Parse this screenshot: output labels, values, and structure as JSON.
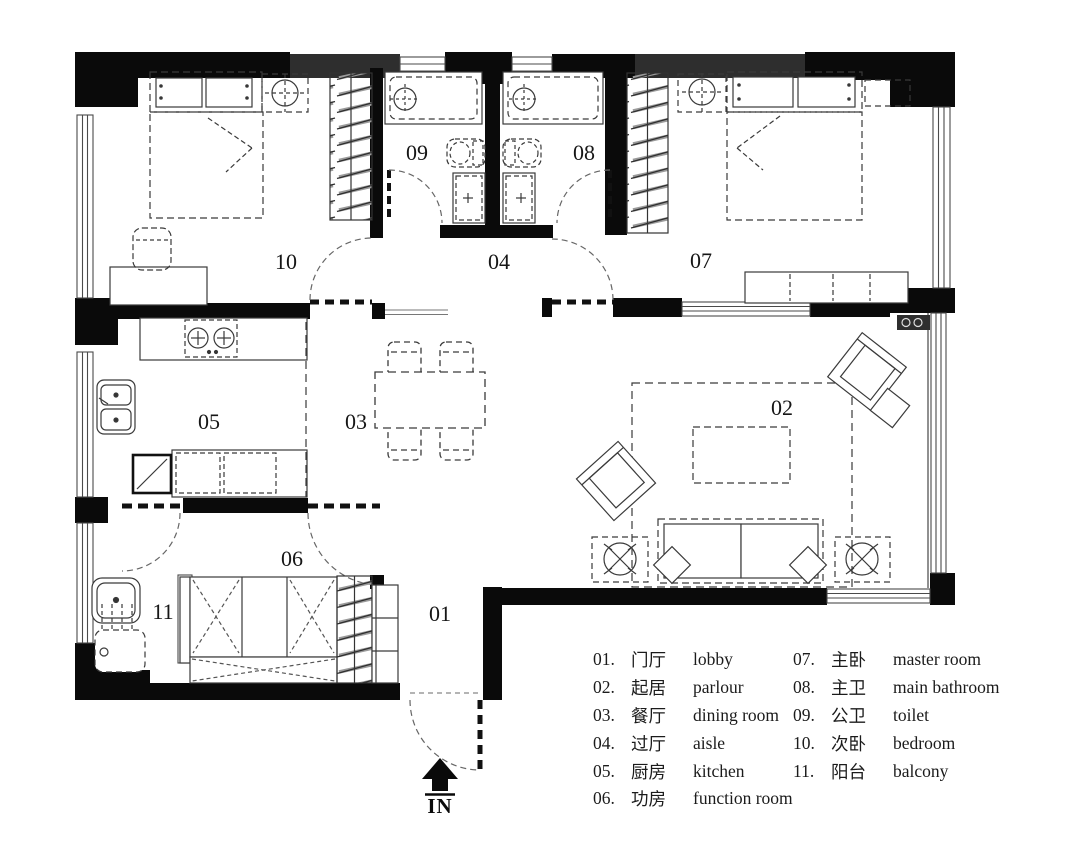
{
  "rooms": [
    {
      "id": "01",
      "legend_num": "01.",
      "zh": "门厅",
      "en": "lobby"
    },
    {
      "id": "02",
      "legend_num": "02.",
      "zh": "起居",
      "en": "parlour"
    },
    {
      "id": "03",
      "legend_num": "03.",
      "zh": "餐厅",
      "en": "dining room"
    },
    {
      "id": "04",
      "legend_num": "04.",
      "zh": "过厅",
      "en": "aisle"
    },
    {
      "id": "05",
      "legend_num": "05.",
      "zh": "厨房",
      "en": "kitchen"
    },
    {
      "id": "06",
      "legend_num": "06.",
      "zh": "功房",
      "en": "function room"
    },
    {
      "id": "07",
      "legend_num": "07.",
      "zh": "主卧",
      "en": "master room"
    },
    {
      "id": "08",
      "legend_num": "08.",
      "zh": "主卫",
      "en": "main bathroom"
    },
    {
      "id": "09",
      "legend_num": "09.",
      "zh": "公卫",
      "en": "toilet"
    },
    {
      "id": "10",
      "legend_num": "10.",
      "zh": "次卧",
      "en": "bedroom"
    },
    {
      "id": "11",
      "legend_num": "11.",
      "zh": "阳台",
      "en": "balcony"
    }
  ],
  "compass": {
    "label": "IN"
  },
  "colors": {
    "wall": "#0a0a0a",
    "wall_gray": "#2e2e2e",
    "line": "#3a3a3a"
  }
}
